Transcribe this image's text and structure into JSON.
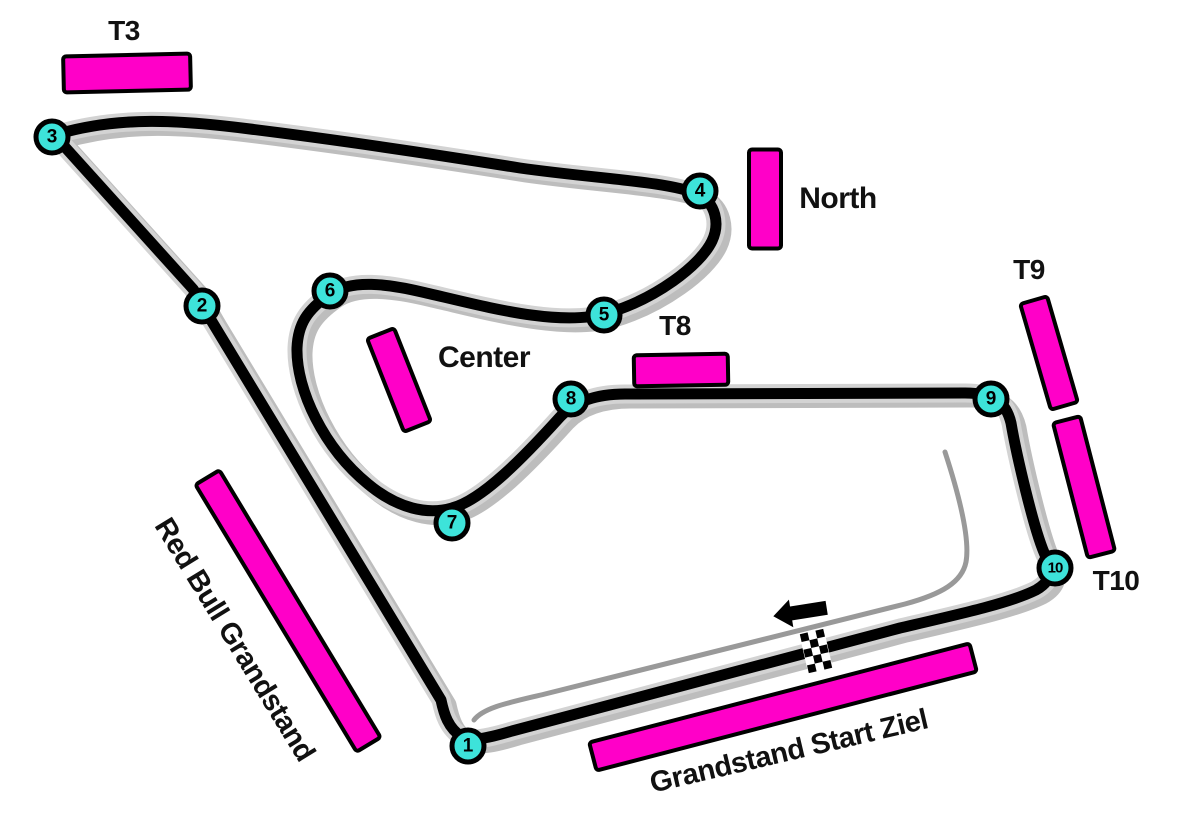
{
  "colors": {
    "grandstand": "#FF00C8",
    "turn_marker": "#3DE3DA",
    "track": "#000000",
    "track_casing": "#D3D3D3",
    "track_shadow": "#BDBDBD",
    "pit_lane": "#999999",
    "label_text": "#111111"
  },
  "markers": {
    "finish_line": "checkered-flag",
    "race_direction": "left"
  },
  "turns": [
    {
      "n": "1",
      "x": 468,
      "y": 746
    },
    {
      "n": "2",
      "x": 202,
      "y": 306
    },
    {
      "n": "3",
      "x": 52,
      "y": 137
    },
    {
      "n": "4",
      "x": 700,
      "y": 191
    },
    {
      "n": "5",
      "x": 604,
      "y": 315
    },
    {
      "n": "6",
      "x": 330,
      "y": 291
    },
    {
      "n": "7",
      "x": 452,
      "y": 523
    },
    {
      "n": "8",
      "x": 571,
      "y": 399
    },
    {
      "n": "9",
      "x": 991,
      "y": 399
    },
    {
      "n": "10",
      "x": 1055,
      "y": 568
    }
  ],
  "grandstands": [
    {
      "id": "t3",
      "label": "T3",
      "bar": {
        "cx": 127,
        "cy": 73,
        "w": 131,
        "h": 40,
        "angle": -1.3
      },
      "label_pos": {
        "cx": 124,
        "cy": 31,
        "size": 28,
        "angle": 0
      }
    },
    {
      "id": "north",
      "label": "North",
      "bar": {
        "cx": 765,
        "cy": 199,
        "w": 36,
        "h": 103,
        "angle": 0
      },
      "label_pos": {
        "cx": 838,
        "cy": 199,
        "size": 30,
        "angle": 0
      }
    },
    {
      "id": "center",
      "label": "Center",
      "bar": {
        "cx": 399,
        "cy": 380,
        "w": 33,
        "h": 104,
        "angle": -21.6
      },
      "label_pos": {
        "cx": 484,
        "cy": 358,
        "size": 30,
        "angle": 0
      }
    },
    {
      "id": "t8",
      "label": "T8",
      "bar": {
        "cx": 681,
        "cy": 370,
        "w": 98,
        "h": 35,
        "angle": -1
      },
      "label_pos": {
        "cx": 675,
        "cy": 326,
        "size": 28,
        "angle": 0
      }
    },
    {
      "id": "t9",
      "label": "T9",
      "bar": {
        "cx": 1049,
        "cy": 353,
        "w": 32,
        "h": 114,
        "angle": -16.2
      },
      "label_pos": {
        "cx": 1029,
        "cy": 270,
        "size": 28,
        "angle": 0
      }
    },
    {
      "id": "t10",
      "label": "T10",
      "bar": {
        "cx": 1084,
        "cy": 487,
        "w": 32,
        "h": 143,
        "angle": -14.5
      },
      "label_pos": {
        "cx": 1116,
        "cy": 581,
        "size": 28,
        "angle": 0
      }
    },
    {
      "id": "red-bull",
      "label": "Red Bull Grandstand",
      "bar": {
        "cx": 288,
        "cy": 611,
        "w": 32,
        "h": 316,
        "angle": -31.1
      },
      "label_pos": {
        "cx": 234,
        "cy": 640,
        "size": 29,
        "angle": 58.5
      }
    },
    {
      "id": "start-ziel",
      "label": "Grandstand Start Ziel",
      "bar": {
        "cx": 783,
        "cy": 707,
        "w": 397,
        "h": 33,
        "angle": -14.6
      },
      "label_pos": {
        "cx": 789,
        "cy": 752,
        "size": 29,
        "angle": -13.2
      }
    }
  ]
}
